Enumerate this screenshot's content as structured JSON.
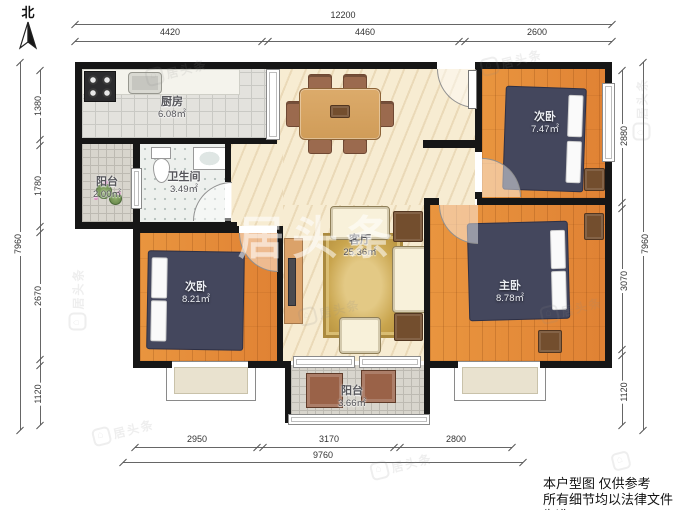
{
  "header": {
    "north_label": "北"
  },
  "rooms": {
    "kitchen": {
      "name": "厨房",
      "area": "6.08㎡"
    },
    "balcony_west": {
      "name": "阳台",
      "area": "2.00㎡"
    },
    "bathroom": {
      "name": "卫生间",
      "area": "3.49㎡"
    },
    "living": {
      "name": "客厅",
      "area": "25.36㎡"
    },
    "bedroom_ne": {
      "name": "次卧",
      "area": "7.47㎡"
    },
    "bedroom_sw": {
      "name": "次卧",
      "area": "8.21㎡"
    },
    "master": {
      "name": "主卧",
      "area": "8.78㎡"
    },
    "balcony_south": {
      "name": "阳台",
      "area": "3.66㎡"
    }
  },
  "dimensions": {
    "top": {
      "total": "12200",
      "seg1": "4420",
      "seg2": "4460",
      "seg3": "2600"
    },
    "bottom": {
      "total": "9760",
      "seg1": "2950",
      "seg2": "3170",
      "seg3": "2800"
    },
    "left": {
      "total": "7960",
      "seg1": "1380",
      "seg2": "1780",
      "seg3": "2670",
      "seg4": "1120"
    },
    "right": {
      "total": "7960",
      "seg1": "2880",
      "seg2": "3070",
      "seg3": "1120"
    }
  },
  "footer": {
    "line1": "本户型图 仅供参考",
    "line2": "所有细节均以法律文件为准"
  },
  "watermark": {
    "brand": "居头条",
    "logo_glyph": "⌂"
  },
  "colors": {
    "wall": "#161616",
    "wood_floor": "#e08a3c",
    "bed": "#44475d",
    "living_floor": "#f7ecd2",
    "tile": "#e3e2dd",
    "rug": "#c9a54e"
  }
}
